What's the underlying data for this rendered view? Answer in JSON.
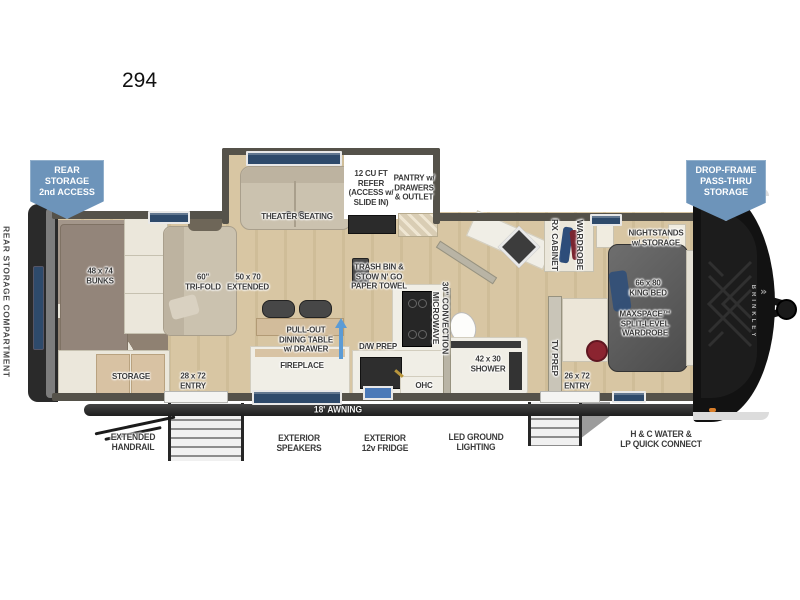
{
  "title": "294",
  "badges": {
    "rear_storage": "REAR\nSTORAGE\n2nd ACCESS",
    "drop_frame": "DROP-FRAME\nPASS-THRU\nSTORAGE"
  },
  "side_label": "REAR STORAGE COMPARTMENT",
  "front_cap_brand": "BRINKLEY",
  "rooms": {
    "bunks": "48 x 74\nBUNKS",
    "storage": "STORAGE",
    "entry_rear": "28 x 72\nENTRY",
    "trifold_sofa": "60\"\nTRI-FOLD",
    "sofa_extended": "50 x 70\nEXTENDED",
    "theater_seating": "THEATER SEATING",
    "refer": "12 CU FT\nREFER\n(ACCESS w/\nSLIDE IN)",
    "pantry": "PANTRY w/\nDRAWERS\n& OUTLET",
    "trash_bin": "TRASH BIN &\nSTOW N' GO\nPAPER TOWEL",
    "dining_table": "PULL-OUT\nDINING TABLE\nw/ DRAWER",
    "fireplace": "FIREPLACE",
    "dw_prep": "D/W PREP",
    "microwave": "30\" CONVECTION\nMICROWAVE",
    "ohc": "OHC",
    "shower": "42 x 30\nSHOWER",
    "rx_cabinet": "RX CABINET",
    "wardrobe": "WARDROBE",
    "tv_prep": "TV PREP",
    "entry_front": "26 x 72\nENTRY",
    "nightstands": "NIGHTSTANDS\nw/ STORAGE",
    "king_bed": "66 x 80\nKING BED",
    "maxspace_wardrobe": "MAXSPACE™\nSPLIT-LEVEL\nWARDROBE"
  },
  "exterior": {
    "awning": "18' AWNING",
    "extended_handrail": "EXTENDED\nHANDRAIL",
    "exterior_speakers": "EXTERIOR\nSPEAKERS",
    "exterior_fridge": "EXTERIOR\n12v FRIDGE",
    "led_lighting": "LED GROUND\nLIGHTING",
    "water_connect": "H & C WATER &\nLP QUICK CONNECT"
  },
  "colors": {
    "badge_blue": "#6d94ba",
    "arrow_blue": "#5b9bd5",
    "window_blue": "#2e4a6b",
    "wall_gray": "#55524a",
    "wood_floor": "#d8c6a3"
  }
}
